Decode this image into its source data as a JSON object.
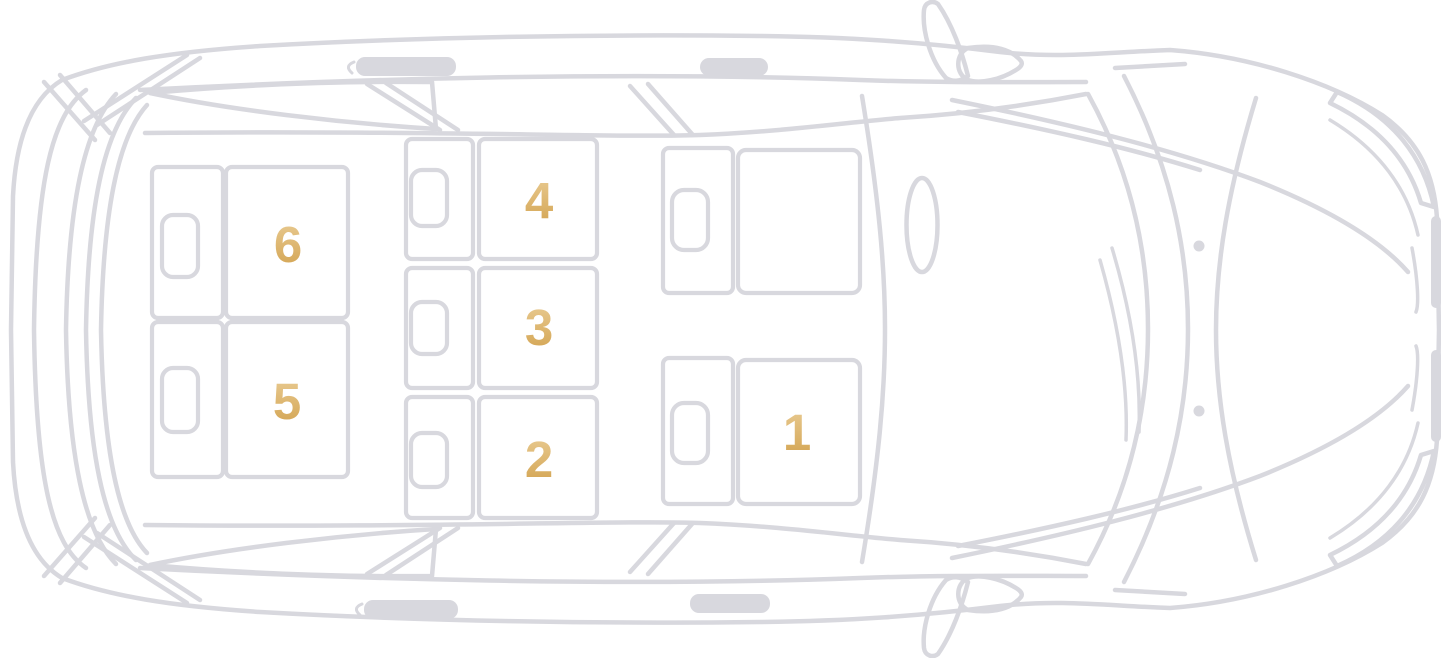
{
  "diagram": {
    "name": "car-seat-map-top-view",
    "background": "#ffffff",
    "line_color": "#d8d8de",
    "seat_number_gradient_top": "#eacd96",
    "seat_number_gradient_bottom": "#d2a24e"
  },
  "seats": [
    {
      "id": "seat-1",
      "label": "1",
      "row": "front",
      "side": "right"
    },
    {
      "id": "seat-2",
      "label": "2",
      "row": "middle",
      "side": "right"
    },
    {
      "id": "seat-3",
      "label": "3",
      "row": "middle",
      "side": "center"
    },
    {
      "id": "seat-4",
      "label": "4",
      "row": "middle",
      "side": "left"
    },
    {
      "id": "seat-5",
      "label": "5",
      "row": "rear",
      "side": "right"
    },
    {
      "id": "seat-6",
      "label": "6",
      "row": "rear",
      "side": "left"
    },
    {
      "id": "driver-seat",
      "label": "",
      "row": "front",
      "side": "left"
    }
  ]
}
